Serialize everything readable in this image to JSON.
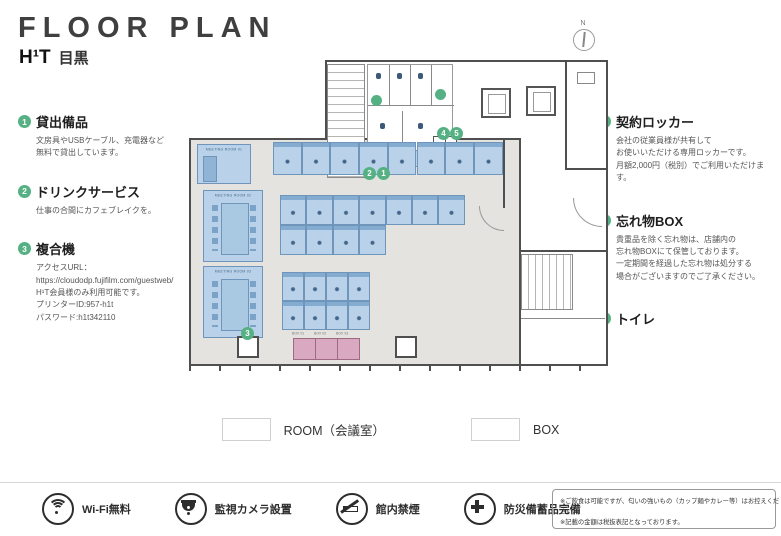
{
  "header": {
    "title": "FLOOR PLAN",
    "brand": "H¹T",
    "location": "目黒"
  },
  "left_notes": [
    {
      "num": "1",
      "title": "貸出備品",
      "body": "文房具やUSBケーブル、充電器など\n無料で貸出しています。"
    },
    {
      "num": "2",
      "title": "ドリンクサービス",
      "body": "仕事の合間にカフェブレイクを。"
    },
    {
      "num": "3",
      "title": "複合機",
      "body": "アクセスURL：\nhttps://cloudodp.fujifilm.com/guestweb/\nH¹T会員様のみ利用可能です。\nプリンターID:957-h1t\nパスワード:h1t342110"
    }
  ],
  "right_notes": [
    {
      "num": "4",
      "title": "契約ロッカー",
      "body": "会社の従業員様が共有して\nお使いいただける専用ロッカーです。\n月額2,000円（税別）でご利用いただけます。"
    },
    {
      "num": "5",
      "title": "忘れ物BOX",
      "body": "貴重品を除く忘れ物は、店舗内の\n忘れ物BOXにて保管しております。\n一定期間を経過した忘れ物は処分する\n場合がございますのでご了承ください。"
    },
    {
      "num": "",
      "title": "トイレ",
      "body": ""
    }
  ],
  "legend": {
    "items": [
      {
        "label": "ROOM（会議室）",
        "color": "#b9d2ea"
      },
      {
        "label": "BOX",
        "color": "#d9a9c1"
      }
    ]
  },
  "facilities": [
    {
      "icon": "wifi-icon",
      "label": "Wi-Fi無料"
    },
    {
      "icon": "camera-icon",
      "label": "監視カメラ設置"
    },
    {
      "icon": "no-smoking-icon",
      "label": "館内禁煙"
    },
    {
      "icon": "first-aid-icon",
      "label": "防災備蓄品完備"
    }
  ],
  "notes": "※ご飲食は可能ですが、匂いの強いもの（カップ麺やカレー等）はお控えください。\n※記載の金額は税抜表記となっております。",
  "plan": {
    "north_label": "N",
    "entrance_label": "ENTRANCE",
    "meeting_rooms": [
      "MEETING ROOM 01",
      "MEETING ROOM 02",
      "MEETING ROOM 03"
    ],
    "box_labels": [
      "BOX 01",
      "BOX 02",
      "BOX 03"
    ],
    "marker_color": "#55b183",
    "room_color": "#b9d2ea",
    "box_color": "#d9a9c1",
    "markers": [
      {
        "label": "1",
        "x": 192,
        "y": 119
      },
      {
        "label": "2",
        "x": 178,
        "y": 119
      },
      {
        "label": "3",
        "x": 56,
        "y": 279
      },
      {
        "label": "4",
        "x": 252,
        "y": 79
      },
      {
        "label": "5",
        "x": 265,
        "y": 79
      },
      {
        "label": "",
        "x": 186,
        "y": 47
      },
      {
        "label": "",
        "x": 250,
        "y": 41
      }
    ]
  }
}
